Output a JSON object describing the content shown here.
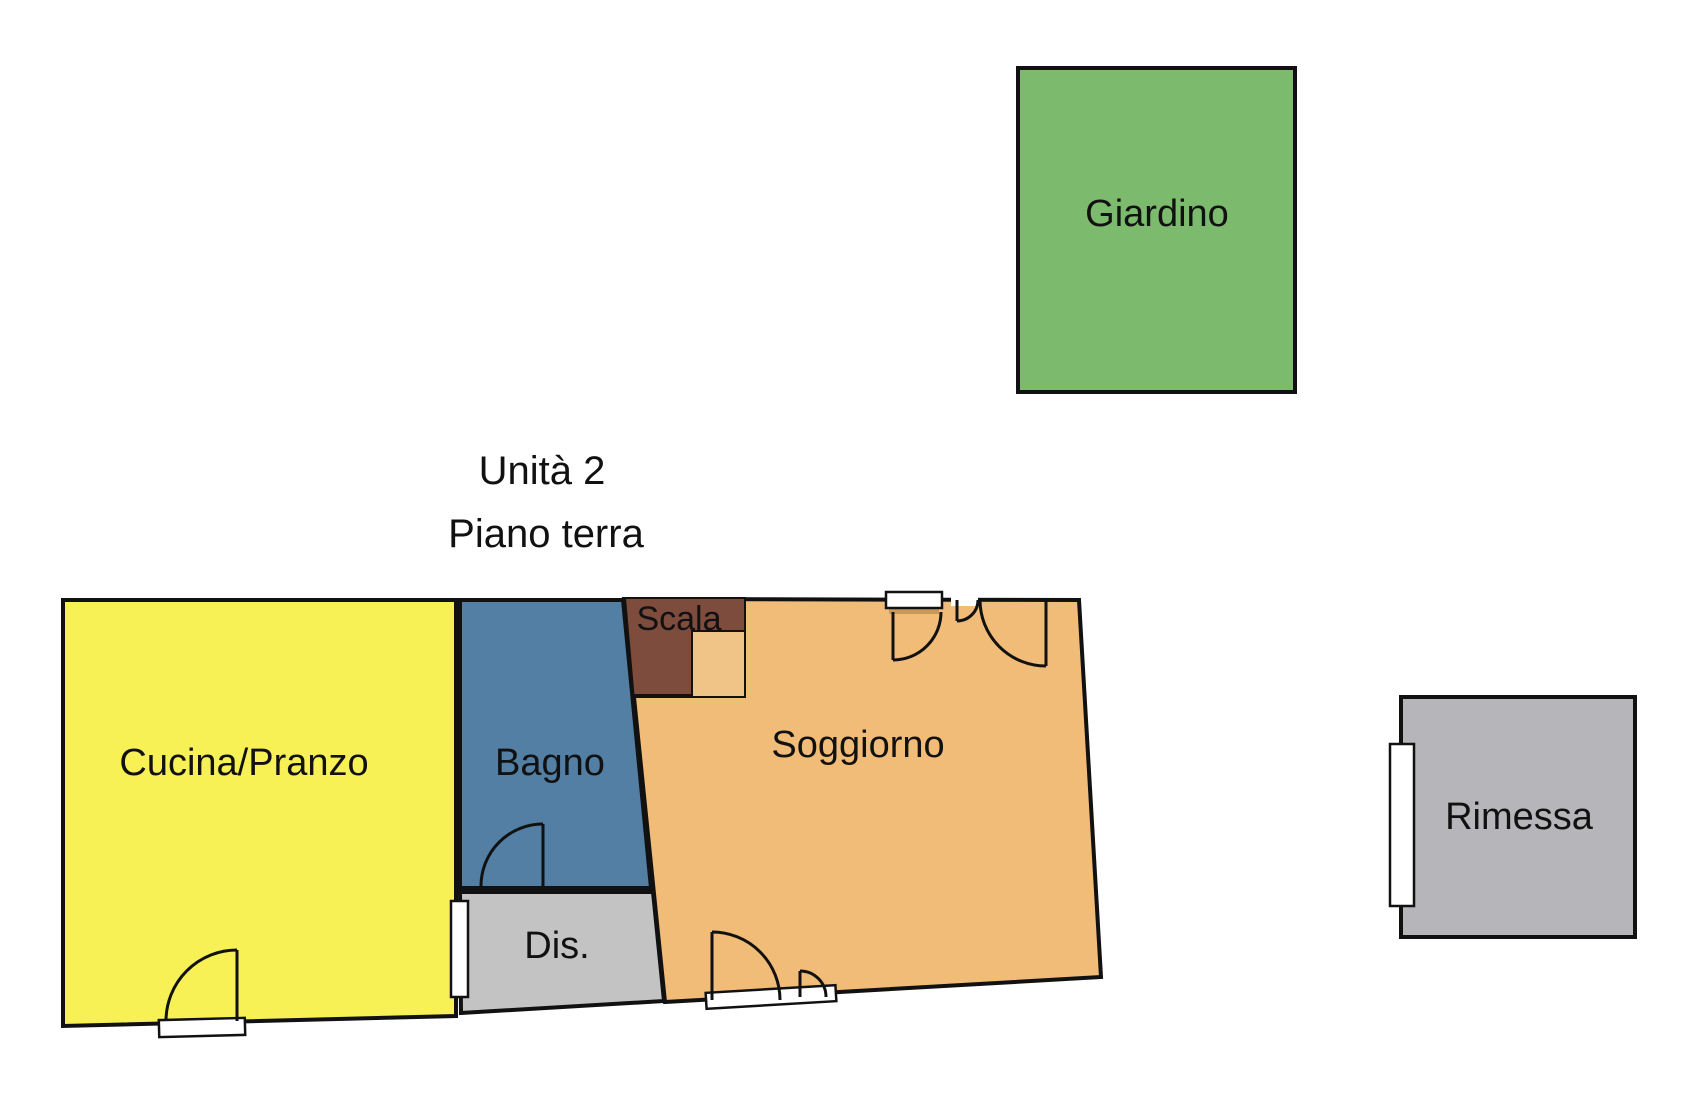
{
  "title": {
    "unit": "Unità 2",
    "floor": "Piano terra"
  },
  "rooms": {
    "giardino": {
      "label": "Giardino",
      "color": "#7cba6d"
    },
    "cucina": {
      "label": "Cucina/Pranzo",
      "color": "#f7f156"
    },
    "bagno": {
      "label": "Bagno",
      "color": "#537fa4"
    },
    "scala": {
      "label": "Scala",
      "stairs_color": "#7d4c3c",
      "landing_color": "#f0c387"
    },
    "soggiorno": {
      "label": "Soggiorno",
      "color": "#f0bc78"
    },
    "dis": {
      "label": "Dis.",
      "color": "#c3c3c4"
    },
    "rimessa": {
      "label": "Rimessa",
      "color": "#b6b6ba"
    }
  },
  "colors": {
    "wall": "#111111",
    "opening": "#ffffff",
    "door_frame": "#c9985b",
    "text": "#111111",
    "background": "#ffffff"
  }
}
